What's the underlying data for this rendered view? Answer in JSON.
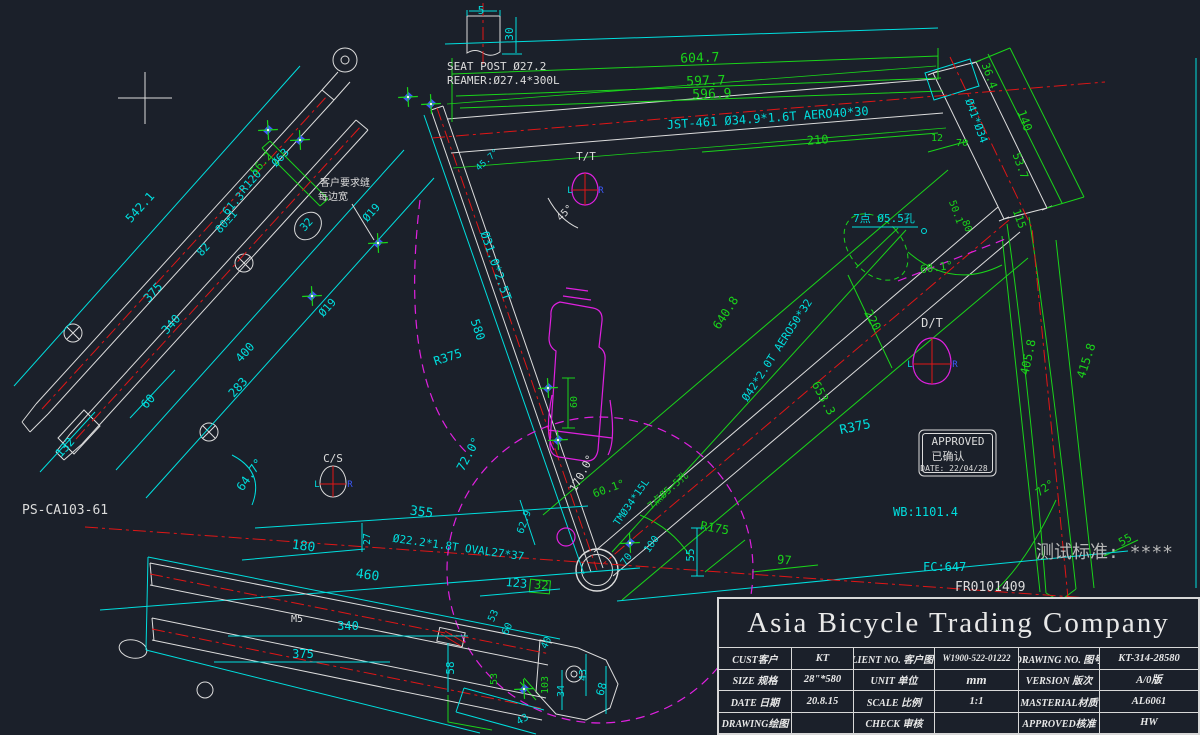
{
  "drawing": {
    "background": "#1b202a",
    "colors": {
      "cyan": "#00dede",
      "green": "#1ad41a",
      "red": "#e01616",
      "magenta": "#e020e0",
      "white": "#dcdcdc",
      "gray": "#b8b8b8",
      "blue": "#3d5aff"
    },
    "approval_stamp": {
      "line1": "APPROVED",
      "line2": "已确认",
      "line3": "DATE: 22/04/28"
    }
  },
  "labels": [
    {
      "name": "dim-5",
      "text": "5",
      "x": 481,
      "y": 14,
      "color": "cyan",
      "size": 11
    },
    {
      "name": "dim-30",
      "text": "30",
      "x": 513,
      "y": 34,
      "rot": -90,
      "color": "cyan",
      "size": 11
    },
    {
      "name": "seat-post-note-1",
      "text": "SEAT POST Ø27.2",
      "x": 447,
      "y": 70,
      "color": "white",
      "size": 11,
      "anchor": "start"
    },
    {
      "name": "seat-post-note-2",
      "text": "REAMER:Ø27.4*300L",
      "x": 447,
      "y": 84,
      "color": "white",
      "size": 11,
      "anchor": "start"
    },
    {
      "name": "dim-604-7",
      "text": "604.7",
      "x": 700,
      "y": 62,
      "rot": -2,
      "color": "green",
      "size": 13
    },
    {
      "name": "dim-597-7",
      "text": "597.7",
      "x": 706,
      "y": 85,
      "rot": -2,
      "color": "green",
      "size": 13
    },
    {
      "name": "dim-596-9",
      "text": "596.9",
      "x": 712,
      "y": 98,
      "rot": -2,
      "color": "green",
      "size": 13
    },
    {
      "name": "top-tube-spec",
      "text": "JST-461  Ø34.9*1.6T AERO40*30",
      "x": 768,
      "y": 122,
      "rot": -4,
      "color": "cyan",
      "size": 12
    },
    {
      "name": "dim-210",
      "text": "210",
      "x": 818,
      "y": 144,
      "rot": -4,
      "color": "green",
      "size": 12
    },
    {
      "name": "dim-12",
      "text": "12",
      "x": 937,
      "y": 141,
      "color": "green",
      "size": 10
    },
    {
      "name": "dim-70-head",
      "text": "70",
      "x": 962,
      "y": 146,
      "color": "green",
      "size": 10
    },
    {
      "name": "tt-section-label",
      "text": "T/T",
      "x": 586,
      "y": 160,
      "color": "white",
      "size": 11
    },
    {
      "name": "dim-45deg",
      "text": "45°",
      "x": 567,
      "y": 215,
      "rot": -45,
      "color": "white",
      "size": 10
    },
    {
      "name": "dim-45-7",
      "text": "45.7°",
      "x": 489,
      "y": 162,
      "rot": -42,
      "color": "cyan",
      "size": 9
    },
    {
      "name": "dim-542-1",
      "text": "542.1",
      "x": 143,
      "y": 210,
      "rot": -48,
      "color": "cyan",
      "size": 12
    },
    {
      "name": "dim-375-stay",
      "text": "375",
      "x": 156,
      "y": 295,
      "rot": -48,
      "color": "cyan",
      "size": 12
    },
    {
      "name": "dim-340-stay",
      "text": "340",
      "x": 174,
      "y": 327,
      "rot": -48,
      "color": "cyan",
      "size": 12
    },
    {
      "name": "dim-82",
      "text": "82",
      "x": 206,
      "y": 252,
      "rot": -48,
      "color": "cyan",
      "size": 11
    },
    {
      "name": "dim-80pm1",
      "text": "80±1",
      "x": 229,
      "y": 224,
      "rot": -48,
      "color": "cyan",
      "size": 11
    },
    {
      "name": "dim-61-3",
      "text": "61.3",
      "x": 236,
      "y": 206,
      "rot": -48,
      "color": "cyan",
      "size": 11
    },
    {
      "name": "dim-r120",
      "text": "R120",
      "x": 253,
      "y": 184,
      "rot": -48,
      "color": "cyan",
      "size": 11
    },
    {
      "name": "dim-56-2",
      "text": "56.2",
      "x": 264,
      "y": 166,
      "rot": -48,
      "color": "green",
      "size": 11
    },
    {
      "name": "dim-d63",
      "text": "Ø63",
      "x": 283,
      "y": 160,
      "rot": -48,
      "color": "cyan",
      "size": 11
    },
    {
      "name": "dim-d19-a",
      "text": "Ø19",
      "x": 374,
      "y": 215,
      "rot": -48,
      "color": "cyan",
      "size": 11
    },
    {
      "name": "dim-d19-b",
      "text": "Ø19",
      "x": 330,
      "y": 310,
      "rot": -48,
      "color": "cyan",
      "size": 11
    },
    {
      "name": "dim-32-circle",
      "text": "32",
      "x": 309,
      "y": 227,
      "rot": -48,
      "color": "cyan",
      "size": 11
    },
    {
      "name": "dim-400",
      "text": "400",
      "x": 248,
      "y": 355,
      "rot": -48,
      "color": "cyan",
      "size": 12
    },
    {
      "name": "dim-283",
      "text": "283",
      "x": 241,
      "y": 390,
      "rot": -48,
      "color": "cyan",
      "size": 12
    },
    {
      "name": "dim-60-stay",
      "text": "60",
      "x": 151,
      "y": 404,
      "rot": -48,
      "color": "cyan",
      "size": 12
    },
    {
      "name": "dim-132",
      "text": "132",
      "x": 68,
      "y": 450,
      "rot": -48,
      "color": "cyan",
      "size": 12
    },
    {
      "name": "weld-note-1",
      "text": "客户要求缝",
      "x": 320,
      "y": 186,
      "anchor": "start",
      "color": "white",
      "size": 10
    },
    {
      "name": "weld-note-2",
      "text": "每边宽",
      "x": 318,
      "y": 200,
      "anchor": "start",
      "color": "white",
      "size": 10
    },
    {
      "name": "seat-tube-spec",
      "text": "Ø31.0*2.5T",
      "x": 492,
      "y": 267,
      "rot": 71,
      "color": "cyan",
      "size": 12
    },
    {
      "name": "dim-580",
      "text": "580",
      "x": 474,
      "y": 331,
      "rot": 71,
      "color": "cyan",
      "size": 12
    },
    {
      "name": "dim-r375-left",
      "text": "R375",
      "x": 449,
      "y": 361,
      "rot": -18,
      "color": "cyan",
      "size": 12
    },
    {
      "name": "dim-72-0deg",
      "text": "72.0°",
      "x": 472,
      "y": 456,
      "rot": -62,
      "color": "cyan",
      "size": 12
    },
    {
      "name": "dim-60-bottle",
      "text": "60",
      "x": 577,
      "y": 402,
      "rot": -90,
      "color": "green",
      "size": 10
    },
    {
      "name": "cs-section-label",
      "text": "C/S",
      "x": 333,
      "y": 462,
      "color": "white",
      "size": 11
    },
    {
      "name": "chainstay-part-ref",
      "text": "PS-CA103-61",
      "x": 22,
      "y": 514,
      "color": "white",
      "size": 13,
      "anchor": "start"
    },
    {
      "name": "dim-64-7deg",
      "text": "64.7°",
      "x": 253,
      "y": 477,
      "rot": -55,
      "color": "cyan",
      "size": 12
    },
    {
      "name": "dim-355",
      "text": "355",
      "x": 421,
      "y": 516,
      "rot": 8,
      "color": "cyan",
      "size": 13
    },
    {
      "name": "dim-180",
      "text": "180",
      "x": 303,
      "y": 550,
      "rot": 8,
      "color": "cyan",
      "size": 13
    },
    {
      "name": "dim-460",
      "text": "460",
      "x": 367,
      "y": 579,
      "rot": 8,
      "color": "cyan",
      "size": 13
    },
    {
      "name": "dim-27",
      "text": "27",
      "x": 370,
      "y": 539,
      "rot": -90,
      "color": "cyan",
      "size": 10
    },
    {
      "name": "chainstay-spec",
      "text": "Ø22.2*1.8T OVAL27*37",
      "x": 458,
      "y": 551,
      "rot": 8,
      "color": "cyan",
      "size": 11
    },
    {
      "name": "dim-123",
      "text": "123",
      "x": 516,
      "y": 587,
      "rot": 5,
      "color": "cyan",
      "size": 12
    },
    {
      "name": "dim-32-green",
      "text": "32",
      "x": 541,
      "y": 589,
      "rot": 5,
      "color": "green",
      "size": 12
    },
    {
      "name": "dim-62-9",
      "text": "62.9",
      "x": 527,
      "y": 523,
      "rot": -70,
      "color": "cyan",
      "size": 10
    },
    {
      "name": "dim-170deg",
      "text": "170.0°",
      "x": 585,
      "y": 475,
      "rot": -62,
      "color": "white",
      "size": 11
    },
    {
      "name": "dim-60-1-bb",
      "text": "60.1°",
      "x": 610,
      "y": 492,
      "rot": -20,
      "color": "green",
      "size": 11
    },
    {
      "name": "bb-seat-spec",
      "text": "TMØ34*15L",
      "x": 634,
      "y": 504,
      "rot": -55,
      "color": "cyan",
      "size": 10
    },
    {
      "name": "holes-note-bb",
      "text": "7点Ø5.5孔",
      "x": 670,
      "y": 493,
      "rot": -42,
      "color": "green",
      "size": 10
    },
    {
      "name": "dim-70-bb",
      "text": "70",
      "x": 629,
      "y": 561,
      "rot": -55,
      "color": "cyan",
      "size": 10
    },
    {
      "name": "dim-100",
      "text": "100",
      "x": 654,
      "y": 546,
      "rot": -55,
      "color": "cyan",
      "size": 10
    },
    {
      "name": "dim-55-bb",
      "text": "55",
      "x": 694,
      "y": 555,
      "rot": -90,
      "color": "cyan",
      "size": 11
    },
    {
      "name": "dim-r175",
      "text": "R175",
      "x": 714,
      "y": 532,
      "rot": 10,
      "color": "green",
      "size": 12
    },
    {
      "name": "dim-97",
      "text": "97",
      "x": 784,
      "y": 564,
      "rot": 5,
      "color": "green",
      "size": 12
    },
    {
      "name": "dim-58",
      "text": "58",
      "x": 454,
      "y": 668,
      "rot": -90,
      "color": "cyan",
      "size": 11
    },
    {
      "name": "dim-53-a",
      "text": "53",
      "x": 496,
      "y": 617,
      "rot": -65,
      "color": "cyan",
      "size": 10
    },
    {
      "name": "dim-60-cs",
      "text": "60",
      "x": 510,
      "y": 630,
      "rot": -65,
      "color": "cyan",
      "size": 10
    },
    {
      "name": "dim-40",
      "text": "40",
      "x": 549,
      "y": 644,
      "rot": -65,
      "color": "cyan",
      "size": 10
    },
    {
      "name": "dim-53-b",
      "text": "53",
      "x": 497,
      "y": 679,
      "rot": -90,
      "color": "green",
      "size": 10
    },
    {
      "name": "dim-103",
      "text": "103",
      "x": 548,
      "y": 685,
      "rot": -90,
      "color": "green",
      "size": 10
    },
    {
      "name": "dim-34",
      "text": "34",
      "x": 564,
      "y": 691,
      "rot": -90,
      "color": "cyan",
      "size": 10
    },
    {
      "name": "dim-43-a",
      "text": "43",
      "x": 586,
      "y": 675,
      "rot": -90,
      "color": "cyan",
      "size": 10
    },
    {
      "name": "dim-68",
      "text": "68",
      "x": 605,
      "y": 690,
      "rot": -75,
      "color": "cyan",
      "size": 11
    },
    {
      "name": "dim-43-b",
      "text": "43",
      "x": 524,
      "y": 722,
      "rot": -30,
      "color": "cyan",
      "size": 10
    },
    {
      "name": "dim-m5",
      "text": "M5",
      "x": 297,
      "y": 622,
      "color": "white",
      "size": 10
    },
    {
      "name": "dim-340-cs",
      "text": "340",
      "x": 348,
      "y": 630,
      "color": "cyan",
      "size": 12
    },
    {
      "name": "dim-375-cs",
      "text": "375",
      "x": 303,
      "y": 658,
      "color": "cyan",
      "size": 12
    },
    {
      "name": "dim-36-4",
      "text": "36.4",
      "x": 986,
      "y": 77,
      "rot": 70,
      "color": "green",
      "size": 11
    },
    {
      "name": "dim-140",
      "text": "140",
      "x": 1021,
      "y": 122,
      "rot": 70,
      "color": "green",
      "size": 12
    },
    {
      "name": "head-tube-spec",
      "text": "Ø41*Ø34",
      "x": 973,
      "y": 122,
      "rot": 70,
      "color": "cyan",
      "size": 11
    },
    {
      "name": "dim-53-7",
      "text": "53.7",
      "x": 1017,
      "y": 167,
      "rot": 70,
      "color": "green",
      "size": 11
    },
    {
      "name": "dim-50-1",
      "text": "50.1",
      "x": 953,
      "y": 213,
      "rot": 70,
      "color": "green",
      "size": 10
    },
    {
      "name": "dim-80-head",
      "text": "80",
      "x": 964,
      "y": 227,
      "rot": 70,
      "color": "green",
      "size": 10
    },
    {
      "name": "dim-115",
      "text": "115",
      "x": 1016,
      "y": 220,
      "rot": 70,
      "color": "green",
      "size": 11
    },
    {
      "name": "holes-note",
      "text": "7点 Ø5.5孔",
      "x": 884,
      "y": 222,
      "color": "cyan",
      "size": 11
    },
    {
      "name": "dim-60-1-head",
      "text": "60.1°",
      "x": 937,
      "y": 271,
      "rot": -8,
      "color": "green",
      "size": 11
    },
    {
      "name": "dim-220",
      "text": "220",
      "x": 869,
      "y": 322,
      "rot": 62,
      "color": "green",
      "size": 12
    },
    {
      "name": "dt-section-label",
      "text": "D/T",
      "x": 932,
      "y": 327,
      "color": "white",
      "size": 12
    },
    {
      "name": "down-tube-spec",
      "text": "Ø42*2.0T AERO50*32",
      "x": 780,
      "y": 352,
      "rot": -57,
      "color": "cyan",
      "size": 11
    },
    {
      "name": "dim-640-8",
      "text": "640.8",
      "x": 729,
      "y": 315,
      "rot": -57,
      "color": "green",
      "size": 12
    },
    {
      "name": "dim-653-3",
      "text": "653.3",
      "x": 820,
      "y": 400,
      "rot": 62,
      "color": "green",
      "size": 12
    },
    {
      "name": "dim-r375-right",
      "text": "R375",
      "x": 856,
      "y": 431,
      "rot": -12,
      "color": "cyan",
      "size": 13
    },
    {
      "name": "dim-405-8",
      "text": "405.8",
      "x": 1032,
      "y": 358,
      "rot": -78,
      "color": "green",
      "size": 12
    },
    {
      "name": "dim-415-8",
      "text": "415.8",
      "x": 1090,
      "y": 362,
      "rot": -72,
      "color": "green",
      "size": 12
    },
    {
      "name": "dim-72deg",
      "text": "72°",
      "x": 1047,
      "y": 491,
      "rot": -35,
      "color": "green",
      "size": 11
    },
    {
      "name": "wheelbase-label",
      "text": "WB:1101.4",
      "x": 893,
      "y": 516,
      "color": "cyan",
      "size": 12,
      "anchor": "start"
    },
    {
      "name": "dim-55-fork",
      "text": "55",
      "x": 1127,
      "y": 543,
      "rot": -30,
      "color": "green",
      "size": 11
    },
    {
      "name": "test-standard",
      "text": "测试标准: ****",
      "x": 1036,
      "y": 558,
      "color": "gray",
      "size": 18,
      "anchor": "start"
    },
    {
      "name": "front-center-label",
      "text": "FC:647",
      "x": 923,
      "y": 571,
      "color": "cyan",
      "size": 12,
      "anchor": "start"
    },
    {
      "name": "frame-number",
      "text": "FR0101409",
      "x": 955,
      "y": 591,
      "color": "white",
      "size": 13,
      "anchor": "start"
    },
    {
      "name": "approved-text",
      "text": "APPROVED",
      "x": 958,
      "y": 445,
      "color": "white",
      "size": 11
    },
    {
      "name": "approved-cn",
      "text": "已确认",
      "x": 948,
      "y": 460,
      "color": "white",
      "size": 11
    },
    {
      "name": "approved-date",
      "text": "DATE: 22/04/28",
      "x": 954,
      "y": 471,
      "color": "white",
      "size": 8
    },
    {
      "name": "tt-icon-l",
      "text": "L",
      "x": 570,
      "y": 193,
      "color": "cyan",
      "size": 9
    },
    {
      "name": "tt-icon-r",
      "text": "R",
      "x": 601,
      "y": 193,
      "color": "blue",
      "size": 9
    },
    {
      "name": "dt-icon-l",
      "text": "L",
      "x": 910,
      "y": 367,
      "color": "cyan",
      "size": 9
    },
    {
      "name": "dt-icon-r",
      "text": "R",
      "x": 955,
      "y": 367,
      "color": "blue",
      "size": 9
    },
    {
      "name": "cs-icon-l",
      "text": "L",
      "x": 317,
      "y": 487,
      "color": "cyan",
      "size": 9
    },
    {
      "name": "cs-icon-r",
      "text": "R",
      "x": 350,
      "y": 487,
      "color": "blue",
      "size": 9
    }
  ],
  "markers": [
    {
      "x": 268,
      "y": 130
    },
    {
      "x": 300,
      "y": 140
    },
    {
      "x": 408,
      "y": 97
    },
    {
      "x": 431,
      "y": 104
    },
    {
      "x": 378,
      "y": 243
    },
    {
      "x": 312,
      "y": 296
    },
    {
      "x": 548,
      "y": 388
    },
    {
      "x": 558,
      "y": 440
    },
    {
      "x": 630,
      "y": 543
    },
    {
      "x": 524,
      "y": 689
    }
  ],
  "title_block": {
    "company": "Asia Bicycle Trading Company",
    "cells": {
      "r1l1": "CUST客户",
      "r1v1": "KT",
      "r1l2": "CLIENT NO. 客户图号",
      "r1v2": "W1900-522-01222",
      "r1l3": "DRAWING NO. 图号",
      "r1v3": "KT-314-28580",
      "r2l1": "SIZE 规格",
      "r2v1": "28\"*580",
      "r2l2": "UNIT 单位",
      "r2v2": "mm",
      "r2l3": "VERSION 版次",
      "r2v3": "A/0版",
      "r3l1": "DATE 日期",
      "r3v1": "20.8.15",
      "r3l2": "SCALE 比例",
      "r3v2": "1:1",
      "r3l3": "MASTERIAL材质",
      "r3v3": "AL6061",
      "r4l1": "DRAWING绘图",
      "r4v1": "",
      "r4l2": "CHECK 审核",
      "r4v2": "",
      "r4l3": "APPROVED核准",
      "r4v3": "HW"
    }
  }
}
